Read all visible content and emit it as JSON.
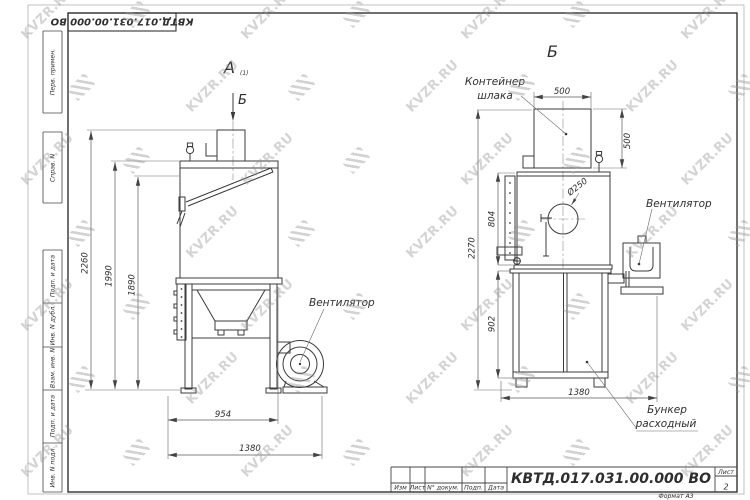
{
  "watermark": {
    "text": "KVZR.RU"
  },
  "corner_stamp": {
    "doc_number": "КВТД.017.031.00.000  ВО"
  },
  "margin_labels": [
    "Перв. примен.",
    "Справ. N",
    "Подп. и дата",
    "Инв. N дубл.",
    "Взам. инв. N",
    "Подп. и дата",
    "Инв. N подл."
  ],
  "view_front": {
    "label": "А",
    "label_note": "(1)",
    "arrow_label": "Б",
    "fan_label": "Вентилятор",
    "dim_total_height": "2260",
    "dim_body_height": "1990",
    "dim_inner_height": "1890",
    "dim_stand_width": "954",
    "dim_total_width": "1380"
  },
  "view_side": {
    "label": "Б",
    "container_label_1": "Контейнер",
    "container_label_2": "шлака",
    "fan_label": "Вентилятор",
    "hopper_label_1": "Бункер",
    "hopper_label_2": "расходный",
    "dim_container_width": "500",
    "dim_container_height": "500",
    "dim_nozzle": "Ø250",
    "dim_total_height": "2270",
    "dim_body_height": "804",
    "dim_cabinet_height": "902",
    "dim_width": "1380"
  },
  "title_block": {
    "doc_number": "КВТД.017.031.00.000  ВО",
    "columns": [
      "Изм",
      "Лист",
      "N° докум.",
      "Подп.",
      "Дата"
    ],
    "sheet_label": "Лист",
    "sheet_number": "2",
    "format_note": "Формат А3"
  }
}
